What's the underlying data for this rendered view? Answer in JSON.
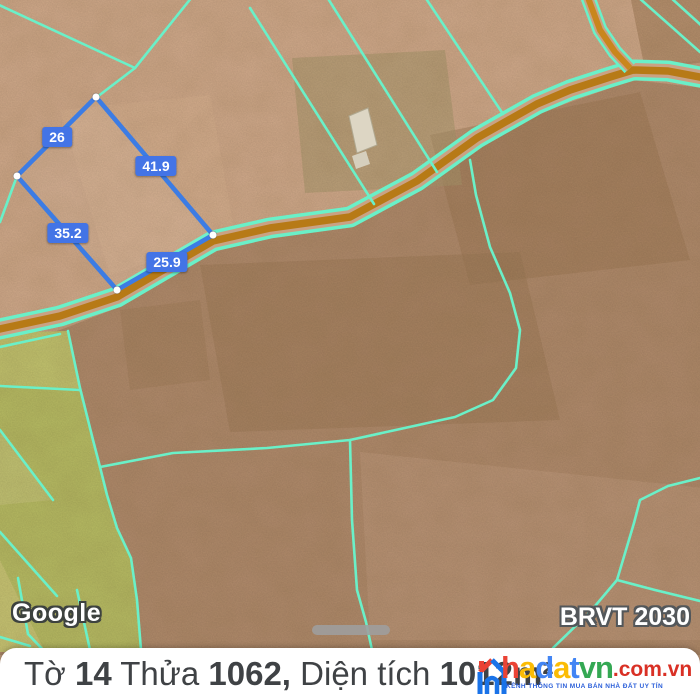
{
  "map": {
    "attribution": "Google",
    "plan_badge": "BRVT 2030",
    "parcel": {
      "edge_measurements": [
        {
          "value": "26"
        },
        {
          "value": "41.9"
        },
        {
          "value": "35.2"
        },
        {
          "value": "25.9"
        }
      ]
    }
  },
  "info_bar": {
    "segments": [
      {
        "text": "Tờ ",
        "bold": false
      },
      {
        "text": "14",
        "bold": true
      },
      {
        "text": " Thửa ",
        "bold": false
      },
      {
        "text": "1062,",
        "bold": true
      },
      {
        "text": " Diện tích ",
        "bold": false
      },
      {
        "text": "1012m²",
        "bold": true
      }
    ]
  },
  "watermark": {
    "letters": [
      {
        "ch": "h"
      },
      {
        "ch": "a"
      },
      {
        "ch": "d"
      },
      {
        "ch": "a"
      },
      {
        "ch": "t"
      },
      {
        "ch": "v"
      },
      {
        "ch": "n"
      }
    ],
    "suffix": ".com.vn",
    "tagline": "KÊNH THÔNG TIN MUA BÁN NHÀ ĐẤT UY TÍN"
  },
  "colors": {
    "parcel_line": "#3c7ce4",
    "measure_label_bg": "#4374e6",
    "cadastral_cyan": "#6af0c8",
    "road_orange": "#b77a16",
    "field_green": "#b8bd64",
    "terrain_tan": "#c6a183",
    "brand_red": "#ea4335",
    "brand_yellow": "#fbbc05",
    "brand_blue": "#4285f4",
    "brand_green": "#34a853",
    "domain_red": "#d93025"
  }
}
